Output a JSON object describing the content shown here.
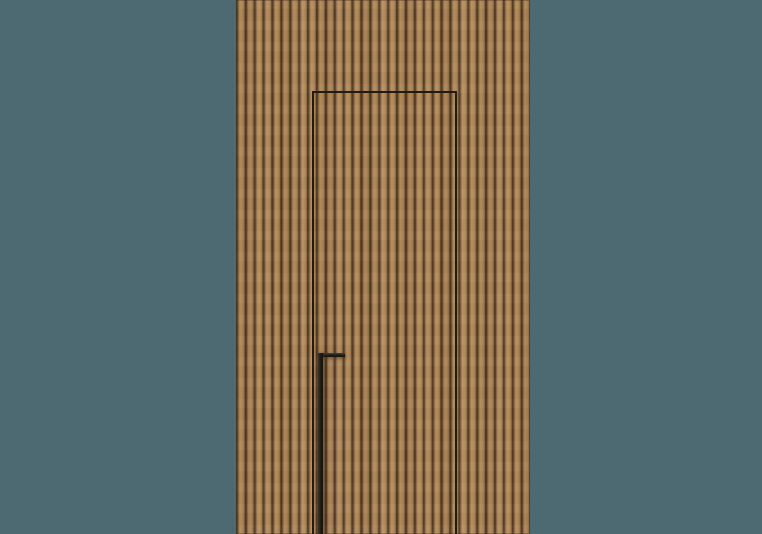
{
  "scene": {
    "description": "Product photo: concealed flush door with black flag-shaped pull handle, set in a wall of vertical wood slats on a plain slate-teal studio background",
    "elements": {
      "background": "plain slate-teal backdrop",
      "panel": "vertical oak slat wall panel, full image height, centered",
      "door": "hidden door marked only by a thin dark seam (top and two sides, open at bottom)",
      "handle": "matte black inverted-L handle near lower left of door, grip runs to bottom edge"
    },
    "colors": {
      "background": "#4d6971",
      "wood_light": "#b68d5d",
      "wood_mid": "#a67c4c",
      "wood_groove": "#4f3a25",
      "wood_groove_soft": "#6e5130",
      "wood_edge_shadow": "#83643e",
      "door_seam": "#241b10",
      "handle_black": "#211e1a"
    }
  }
}
